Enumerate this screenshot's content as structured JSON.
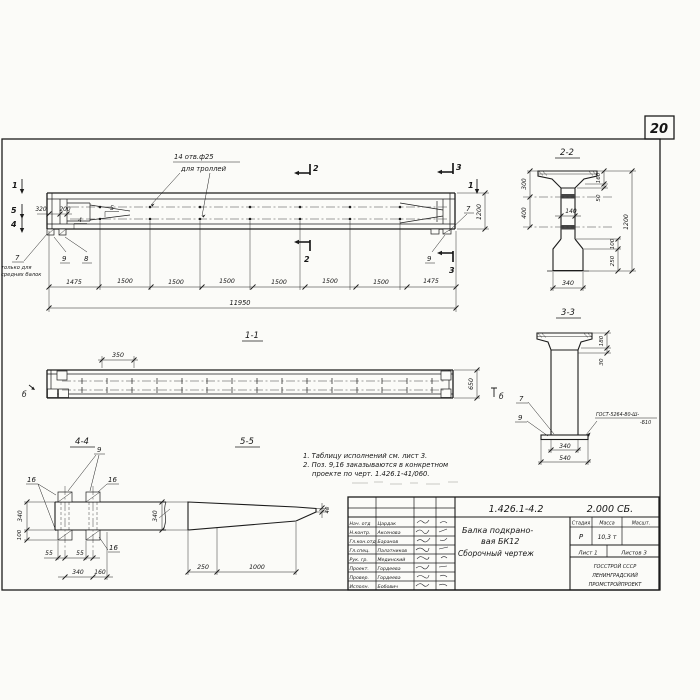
{
  "sheet": {
    "number": "20"
  },
  "elevation": {
    "hole_note_line1": "14 отв.ф25",
    "hole_note_line2": "для троллей",
    "cut_1": "1",
    "cut_2": "2",
    "cut_3": "3",
    "cut_4": "4",
    "cut_5": "5",
    "pos_4": "4",
    "pos_5": "5",
    "pos_7": "7",
    "pos_8": "8",
    "pos_9": "9",
    "only_note_line1": "только для",
    "only_note_line2": "средних балок",
    "dim_320": "320",
    "dim_200": "200",
    "dim_1200": "1200",
    "chain": [
      "1475",
      "1500",
      "1500",
      "1500",
      "1500",
      "1500",
      "1500",
      "1475"
    ],
    "dim_total": "11950"
  },
  "section11": {
    "title": "1-1",
    "dim_350": "350",
    "dim_650": "650",
    "marker_b": "б"
  },
  "section22": {
    "title": "2-2",
    "dim_300": "300",
    "dim_400": "400",
    "dim_140": "140",
    "dim_160": "160",
    "dim_50": "50",
    "dim_1200": "1200",
    "dim_100": "100",
    "dim_250": "250",
    "dim_340": "340"
  },
  "section33": {
    "title": "3-3",
    "dim_180": "180",
    "dim_30": "30",
    "pos_7": "7",
    "pos_9": "9",
    "weld_line1": "ГОСТ-5264-80-Ш-",
    "weld_line2": "-Б10",
    "dim_340": "340",
    "dim_540": "540"
  },
  "section44": {
    "title": "4-4",
    "pos_9": "9",
    "pos_16": "16",
    "dim_340_left": "340",
    "dim_100": "100",
    "dim_55a": "55",
    "dim_55b": "55",
    "dim_340_bottom": "340",
    "dim_160": "160"
  },
  "section55": {
    "title": "5-5",
    "dim_340": "340",
    "dim_40": "40",
    "dim_250": "250",
    "dim_1000": "1000"
  },
  "notes": {
    "line1": "1. Таблицу исполнений см. лист 3.",
    "line2": "2. Поз. 9,16 заказываются в конкретном",
    "line3": "проекте по черт. 1.426.1-41/060."
  },
  "titleblock": {
    "doc_number": "1.426.1-4.2",
    "doc_suffix": "2.000 СБ.",
    "title_line1": "Балка подкрано-",
    "title_line2": "вая БК12",
    "title_line3": "Сборочный чертеж",
    "stage_header": "Стадия",
    "mass_header": "Масса",
    "scale_header": "Масшт.",
    "stage_value": "Р",
    "mass_value": "10,3 т",
    "sheet_label": "Лист 1",
    "sheets_label": "Листов 3",
    "org_line1": "ГОССТРОЙ СССР",
    "org_line2": "ЛЕНИНГРАДСКИЙ",
    "org_line3": "ПРОМСТРОЙПРОЕКТ",
    "staff": [
      {
        "role": "Нач. отд",
        "name": "Цардак"
      },
      {
        "role": "Н.контр.",
        "name": "Аксенова"
      },
      {
        "role": "Гл.кон.отд",
        "name": "Баранов"
      },
      {
        "role": "Гл.спец.",
        "name": "Палатников"
      },
      {
        "role": "Рук. гр.",
        "name": "Мединский"
      },
      {
        "role": "Проект.",
        "name": "Гордеева"
      },
      {
        "role": "Провер.",
        "name": "Гордеева"
      },
      {
        "role": "Исполн.",
        "name": "Бобович"
      }
    ]
  }
}
